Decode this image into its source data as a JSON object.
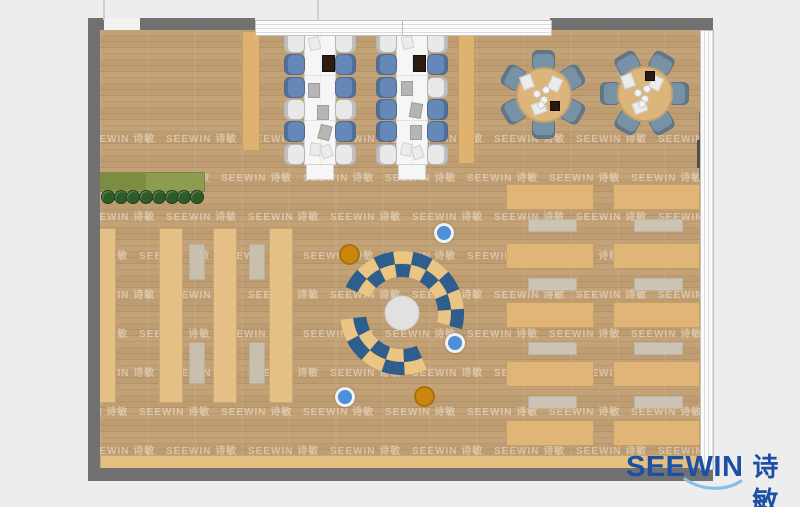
{
  "brand": {
    "en": "SEEWIN",
    "zh": "诗敏",
    "color": "#1c50a6",
    "swoosh": "#86c0ea"
  },
  "watermark": {
    "text": "SEEWIN 诗敏",
    "color": "rgba(255,250,240,0.42)",
    "row_start": 130,
    "rows": 9,
    "row_step": 39,
    "col_start": 24,
    "col_step": 82,
    "odd_row_shift": -27
  },
  "palette": {
    "bg": "#ededed",
    "floor": "#c4a277",
    "wall": "#717171",
    "wall_dark": "#4e4e4e",
    "desk_white": "#f6f6f6",
    "chair_blue": "#6688b8",
    "chair_white": "#e9e9e9",
    "chair_slate": "#7792a5",
    "table_wood": "#dcb57b",
    "shelf": "#e4c087",
    "aisle": "#c9c2b2",
    "read_desk": "#e0b577",
    "read_bench": "#cdc7ba",
    "bench_bottom": "#e3bf80",
    "navy": "#2d5e8e",
    "arc_tan": "#eac584",
    "center_circle": "#e1e1e1",
    "stool_blue": "#4e90d8",
    "stool_orange": "#c9870e",
    "planter": "#8d9d50",
    "planter_dark": "#7d8c43",
    "plant": "#2e5b28",
    "laptop": "#2e1c12",
    "paper": "#ececec",
    "tablet": "#b5b5b5",
    "partition": "#dfb26f",
    "glass_line": "#cfcfcf"
  },
  "layout": {
    "canvas": {
      "w": 800,
      "h": 507
    },
    "floor": {
      "x": 100,
      "y": 27,
      "w": 600,
      "h": 441
    },
    "walls": [
      {
        "x": 88,
        "y": 18,
        "w": 12,
        "h": 463,
        "c": "wall"
      },
      {
        "x": 88,
        "y": 18,
        "w": 16,
        "h": 12,
        "c": "wall"
      },
      {
        "x": 140,
        "y": 18,
        "w": 115,
        "h": 12,
        "c": "wall"
      },
      {
        "x": 550,
        "y": 18,
        "w": 163,
        "h": 12,
        "c": "wall"
      },
      {
        "x": 88,
        "y": 468,
        "w": 625,
        "h": 13,
        "c": "wall"
      },
      {
        "x": 699,
        "y": 112,
        "w": 14,
        "h": 68,
        "c": "wall"
      },
      {
        "x": 697,
        "y": 140,
        "w": 4,
        "h": 28,
        "c": "wall_dark"
      }
    ],
    "door_gap": {
      "x": 104,
      "y": 18,
      "w": 36,
      "h": 12
    },
    "glass": [
      {
        "x": 255,
        "y": 20,
        "w": 295,
        "h": 14,
        "dir": "h",
        "divider_x": 401
      },
      {
        "x": 700,
        "y": 30,
        "w": 12,
        "h": 438,
        "dir": "v"
      }
    ],
    "thin_lines": [
      {
        "x": 103,
        "y": 0,
        "w": 2,
        "h": 20
      },
      {
        "x": 317,
        "y": 0,
        "w": 2,
        "h": 21
      }
    ]
  },
  "furniture": {
    "desk_clusters": [
      {
        "x": 304,
        "y": 30,
        "w": 30,
        "h": 133,
        "cap_h": 14,
        "left": [
          "w",
          "b",
          "b",
          "w",
          "b",
          "w"
        ],
        "right": [
          "w",
          "b",
          "b",
          "w",
          "b",
          "w"
        ],
        "items": [
          {
            "t": "paper",
            "dx": 4,
            "dy": 6,
            "r": -12
          },
          {
            "t": "laptop",
            "dx": 17,
            "dy": 24,
            "r": 0
          },
          {
            "t": "tablet",
            "dx": 3,
            "dy": 52,
            "r": 0
          },
          {
            "t": "tablet",
            "dx": 12,
            "dy": 74,
            "r": 0
          },
          {
            "t": "tablet",
            "dx": 14,
            "dy": 94,
            "r": 15
          },
          {
            "t": "paper",
            "dx": 5,
            "dy": 112,
            "r": 8
          },
          {
            "t": "paper",
            "dx": 16,
            "dy": 114,
            "r": -20
          }
        ]
      },
      {
        "x": 396,
        "y": 30,
        "w": 30,
        "h": 133,
        "cap_h": 14,
        "left": [
          "w",
          "b",
          "b",
          "b",
          "b",
          "w"
        ],
        "right": [
          "w",
          "b",
          "w",
          "b",
          "b",
          "w"
        ],
        "items": [
          {
            "t": "paper",
            "dx": 5,
            "dy": 5,
            "r": -14
          },
          {
            "t": "laptop",
            "dx": 16,
            "dy": 24,
            "r": 0
          },
          {
            "t": "tablet",
            "dx": 4,
            "dy": 50,
            "r": 0
          },
          {
            "t": "tablet",
            "dx": 13,
            "dy": 72,
            "r": 10
          },
          {
            "t": "tablet",
            "dx": 13,
            "dy": 94,
            "r": 0
          },
          {
            "t": "paper",
            "dx": 4,
            "dy": 112,
            "r": 12
          },
          {
            "t": "paper",
            "dx": 15,
            "dy": 115,
            "r": -18
          }
        ]
      }
    ],
    "partitions": [
      {
        "x": 242,
        "y": 31,
        "w": 16,
        "h": 118
      },
      {
        "x": 458,
        "y": 31,
        "w": 15,
        "h": 131
      }
    ],
    "round_tables": [
      {
        "cx": 542,
        "cy": 93,
        "r": 26,
        "angles": [
          30,
          90,
          150,
          210,
          270,
          330
        ],
        "dark": {
          "dx": 12,
          "dy": 12
        }
      },
      {
        "cx": 643,
        "cy": 92,
        "r": 26,
        "angles": [
          0,
          60,
          120,
          180,
          240,
          300
        ],
        "dark": {
          "dx": 6,
          "dy": -17
        }
      }
    ],
    "shelves": [
      {
        "x": 96,
        "y": 228,
        "w": 18,
        "h": 173
      },
      {
        "x": 159,
        "y": 228,
        "w": 22,
        "h": 173
      },
      {
        "x": 213,
        "y": 228,
        "w": 22,
        "h": 173
      },
      {
        "x": 269,
        "y": 228,
        "w": 22,
        "h": 173
      }
    ],
    "aisle_tables": [
      {
        "x": 189,
        "y": 244,
        "w": 14,
        "h": 34
      },
      {
        "x": 249,
        "y": 244,
        "w": 14,
        "h": 34
      },
      {
        "x": 189,
        "y": 342,
        "w": 14,
        "h": 40
      },
      {
        "x": 249,
        "y": 342,
        "w": 14,
        "h": 40
      }
    ],
    "reading_desks": {
      "cols": [
        {
          "x": 506,
          "w": 86
        },
        {
          "x": 613,
          "w": 85
        }
      ],
      "ys": [
        184,
        243,
        302,
        361,
        420
      ],
      "h": 24
    },
    "reading_benches": {
      "cols": [
        {
          "x": 528,
          "w": 47
        },
        {
          "x": 634,
          "w": 47
        }
      ],
      "ys": [
        219,
        278,
        342,
        396
      ],
      "h": 11
    },
    "bottom_bench": {
      "x": 100,
      "y": 455,
      "w": 599,
      "h": 13
    },
    "planter": {
      "x": 100,
      "y": 172,
      "w": 103,
      "h": 18,
      "plants": 8,
      "plant_y": 196,
      "plant_r": 6
    },
    "stools": [
      {
        "x": 444,
        "y": 233,
        "c": "blue"
      },
      {
        "x": 347,
        "y": 252,
        "c": "orange"
      },
      {
        "x": 455,
        "y": 343,
        "c": "blue"
      },
      {
        "x": 345,
        "y": 397,
        "c": "blue"
      },
      {
        "x": 422,
        "y": 394,
        "c": "orange"
      }
    ],
    "lounge": {
      "cx": 402,
      "cy": 313,
      "r_in": 36,
      "r_mid": 49,
      "r_out": 62,
      "center_r": 17,
      "arcs": [
        {
          "from": -15,
          "to": 155,
          "segs": 9,
          "outer_first": "navy"
        },
        {
          "from": 186,
          "to": 294,
          "segs": 5,
          "outer_first": "tan"
        }
      ]
    }
  }
}
